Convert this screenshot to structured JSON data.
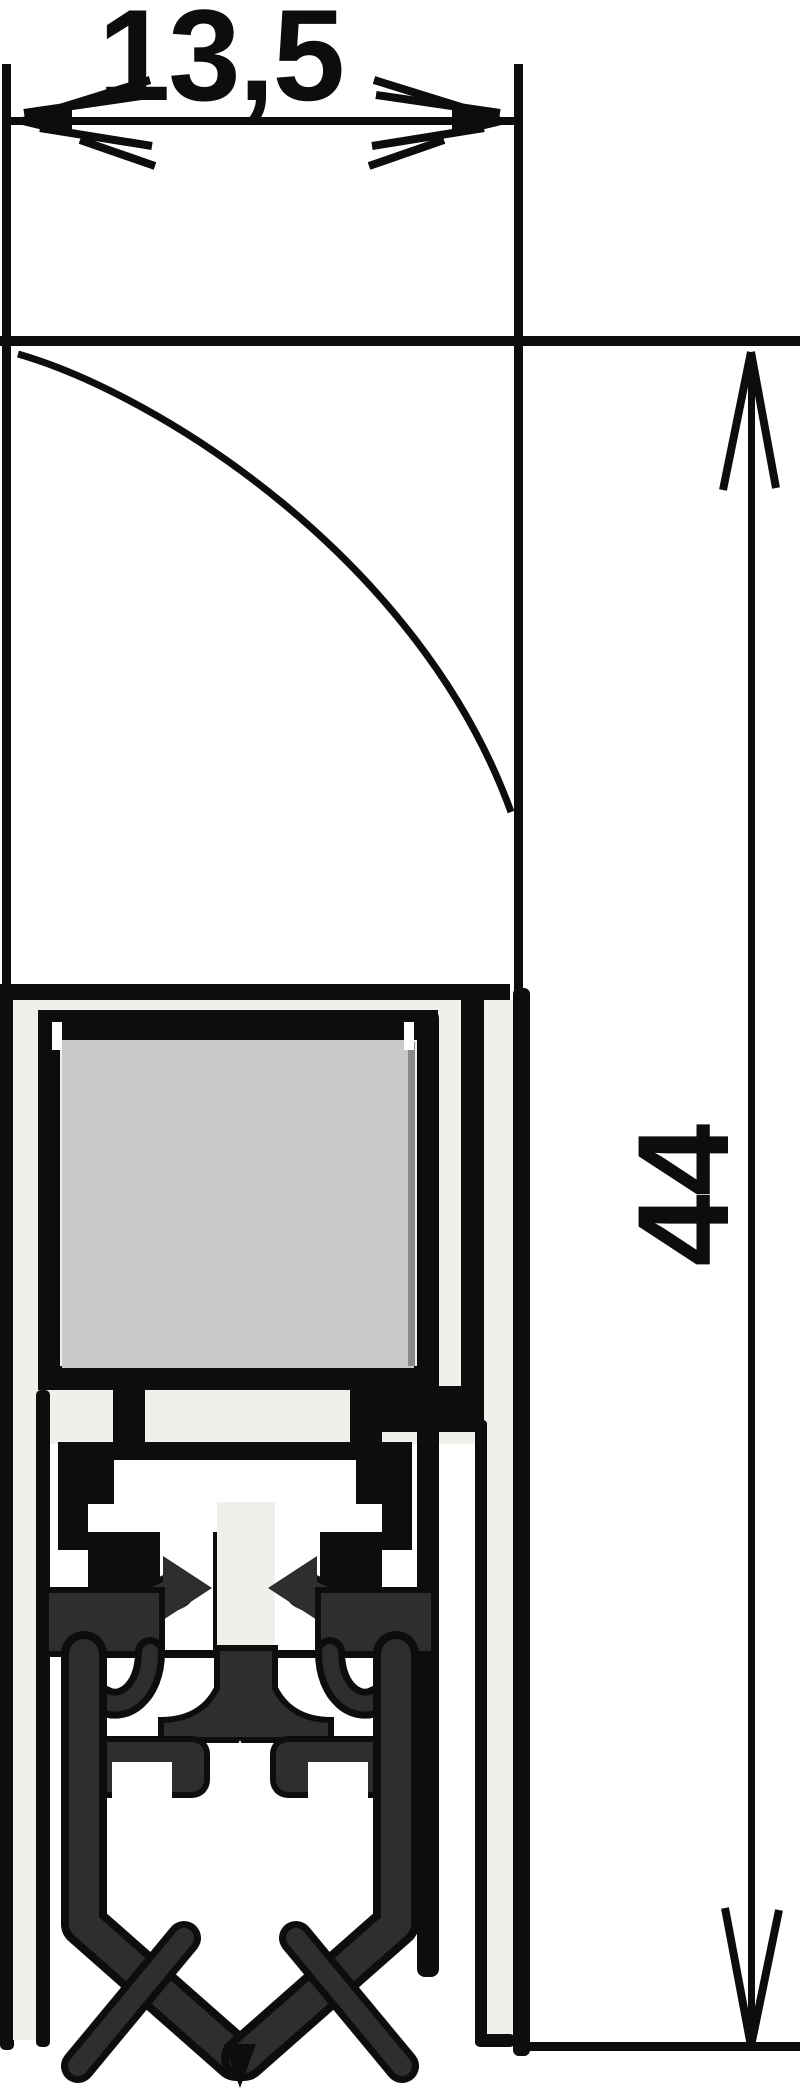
{
  "drawing": {
    "type": "technical-cross-section",
    "width_dim": {
      "label": "13,5",
      "value_mm": 13.5,
      "orientation": "horizontal"
    },
    "height_dim": {
      "label": "44",
      "value_mm": 44,
      "orientation": "vertical-rotated"
    },
    "colors": {
      "line": "#0d0d0d",
      "rubber": "#2e2e2e",
      "foam": "#c9c9c7",
      "casing": "#f0efe9",
      "background": "#ffffff"
    }
  }
}
